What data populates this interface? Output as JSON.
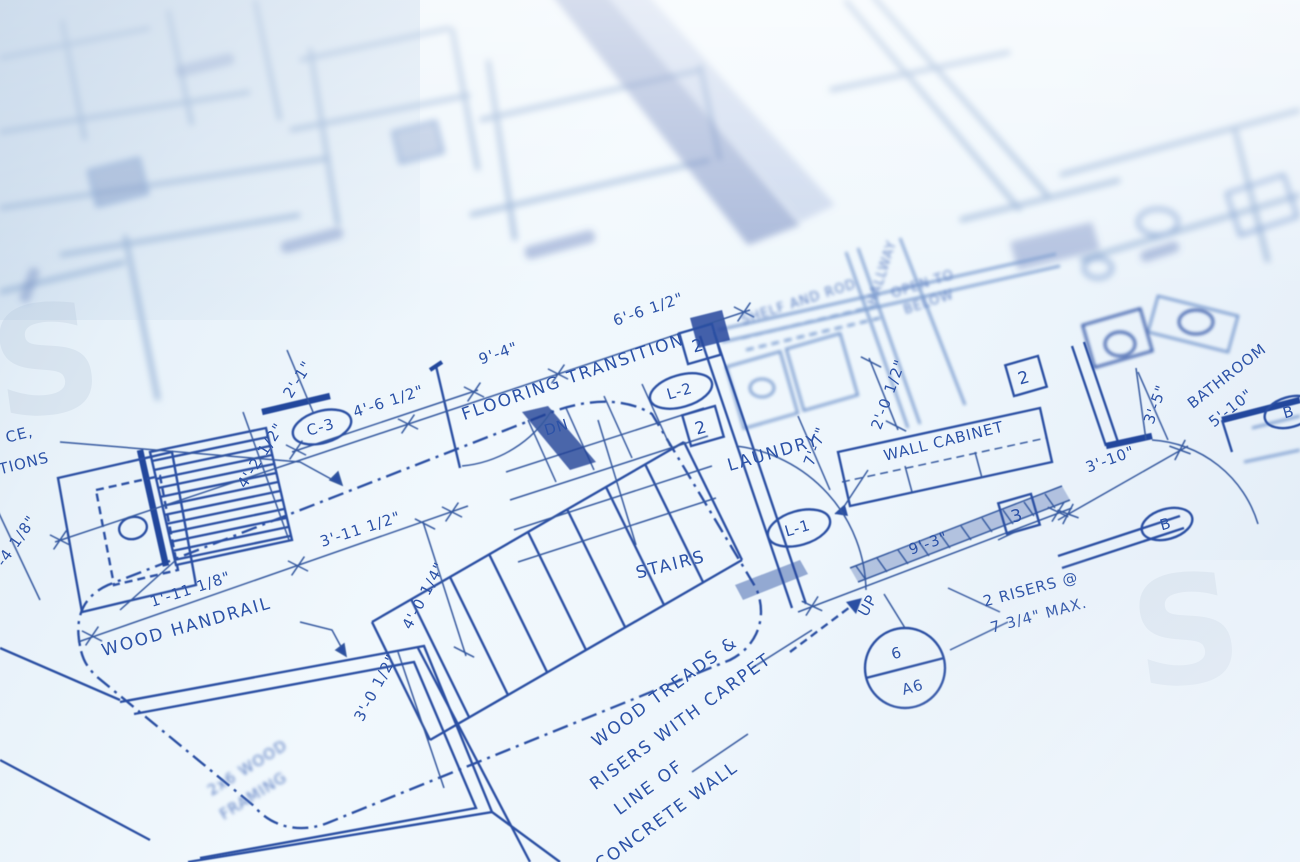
{
  "colors": {
    "ink": "#2c52a7",
    "ink_dark": "#24479c",
    "ink_soft": "#93afd4",
    "paper": "#eef6fc"
  },
  "watermark": {
    "glyph": "S"
  },
  "labels": {
    "flooring_transition": "FLOORING TRANSITION",
    "stairs": "STAIRS",
    "dn": "DN",
    "up": "UP",
    "laundry": "LAUNDRY",
    "bathroom": "BATHROOM",
    "hallway": "HALLWAY",
    "wood_handrail": "WOOD HANDRAIL",
    "wall_cabinet": "WALL CABINET",
    "shelf_and_rod": "SHELF AND ROD",
    "open_to_line1": "OPEN TO",
    "open_to_line2": "BELOW",
    "treads_line1": "WOOD TREADS &",
    "treads_line2": "RISERS WITH CARPET",
    "concrete_line1": "LINE OF",
    "concrete_line2": "CONCRETE WALL",
    "framing_line1": "2x6 WOOD",
    "framing_line2": "FRAMING",
    "risers_line1": "2 RISERS @",
    "risers_line2": "7 3/4\" MAX.",
    "partial_line1": "CE,",
    "partial_line2": "TIONS"
  },
  "dimensions": {
    "d9_4": "9'-4\"",
    "d6_6": "6'-6 1/2\"",
    "d4_6": "4'-6 1/2\"",
    "d2_1": "2'-1\"",
    "d4_2": "4'-2 1/2\"",
    "d3_4": "3'-4 1/8\"",
    "d1_11": "1'-11 1/8\"",
    "d3_11": "3'-11 1/2\"",
    "d4_0": "4'-0 1/4\"",
    "d3_0": "3'-0 1/2\"",
    "d7_7": "7'-7\"",
    "d2_0": "2'-0 1/2\"",
    "d9_3": "9'-3\"",
    "d3_10": "3'-10\"",
    "d3_5": "3'-5\"",
    "d5_10": "5'-10\""
  },
  "keynotes": {
    "square_2": "2",
    "square_3": "3",
    "door_c3": "C-3",
    "door_l1": "L-1",
    "door_l2": "L-2",
    "oval_b": "B",
    "detail_number": "6",
    "detail_sheet": "A6"
  }
}
